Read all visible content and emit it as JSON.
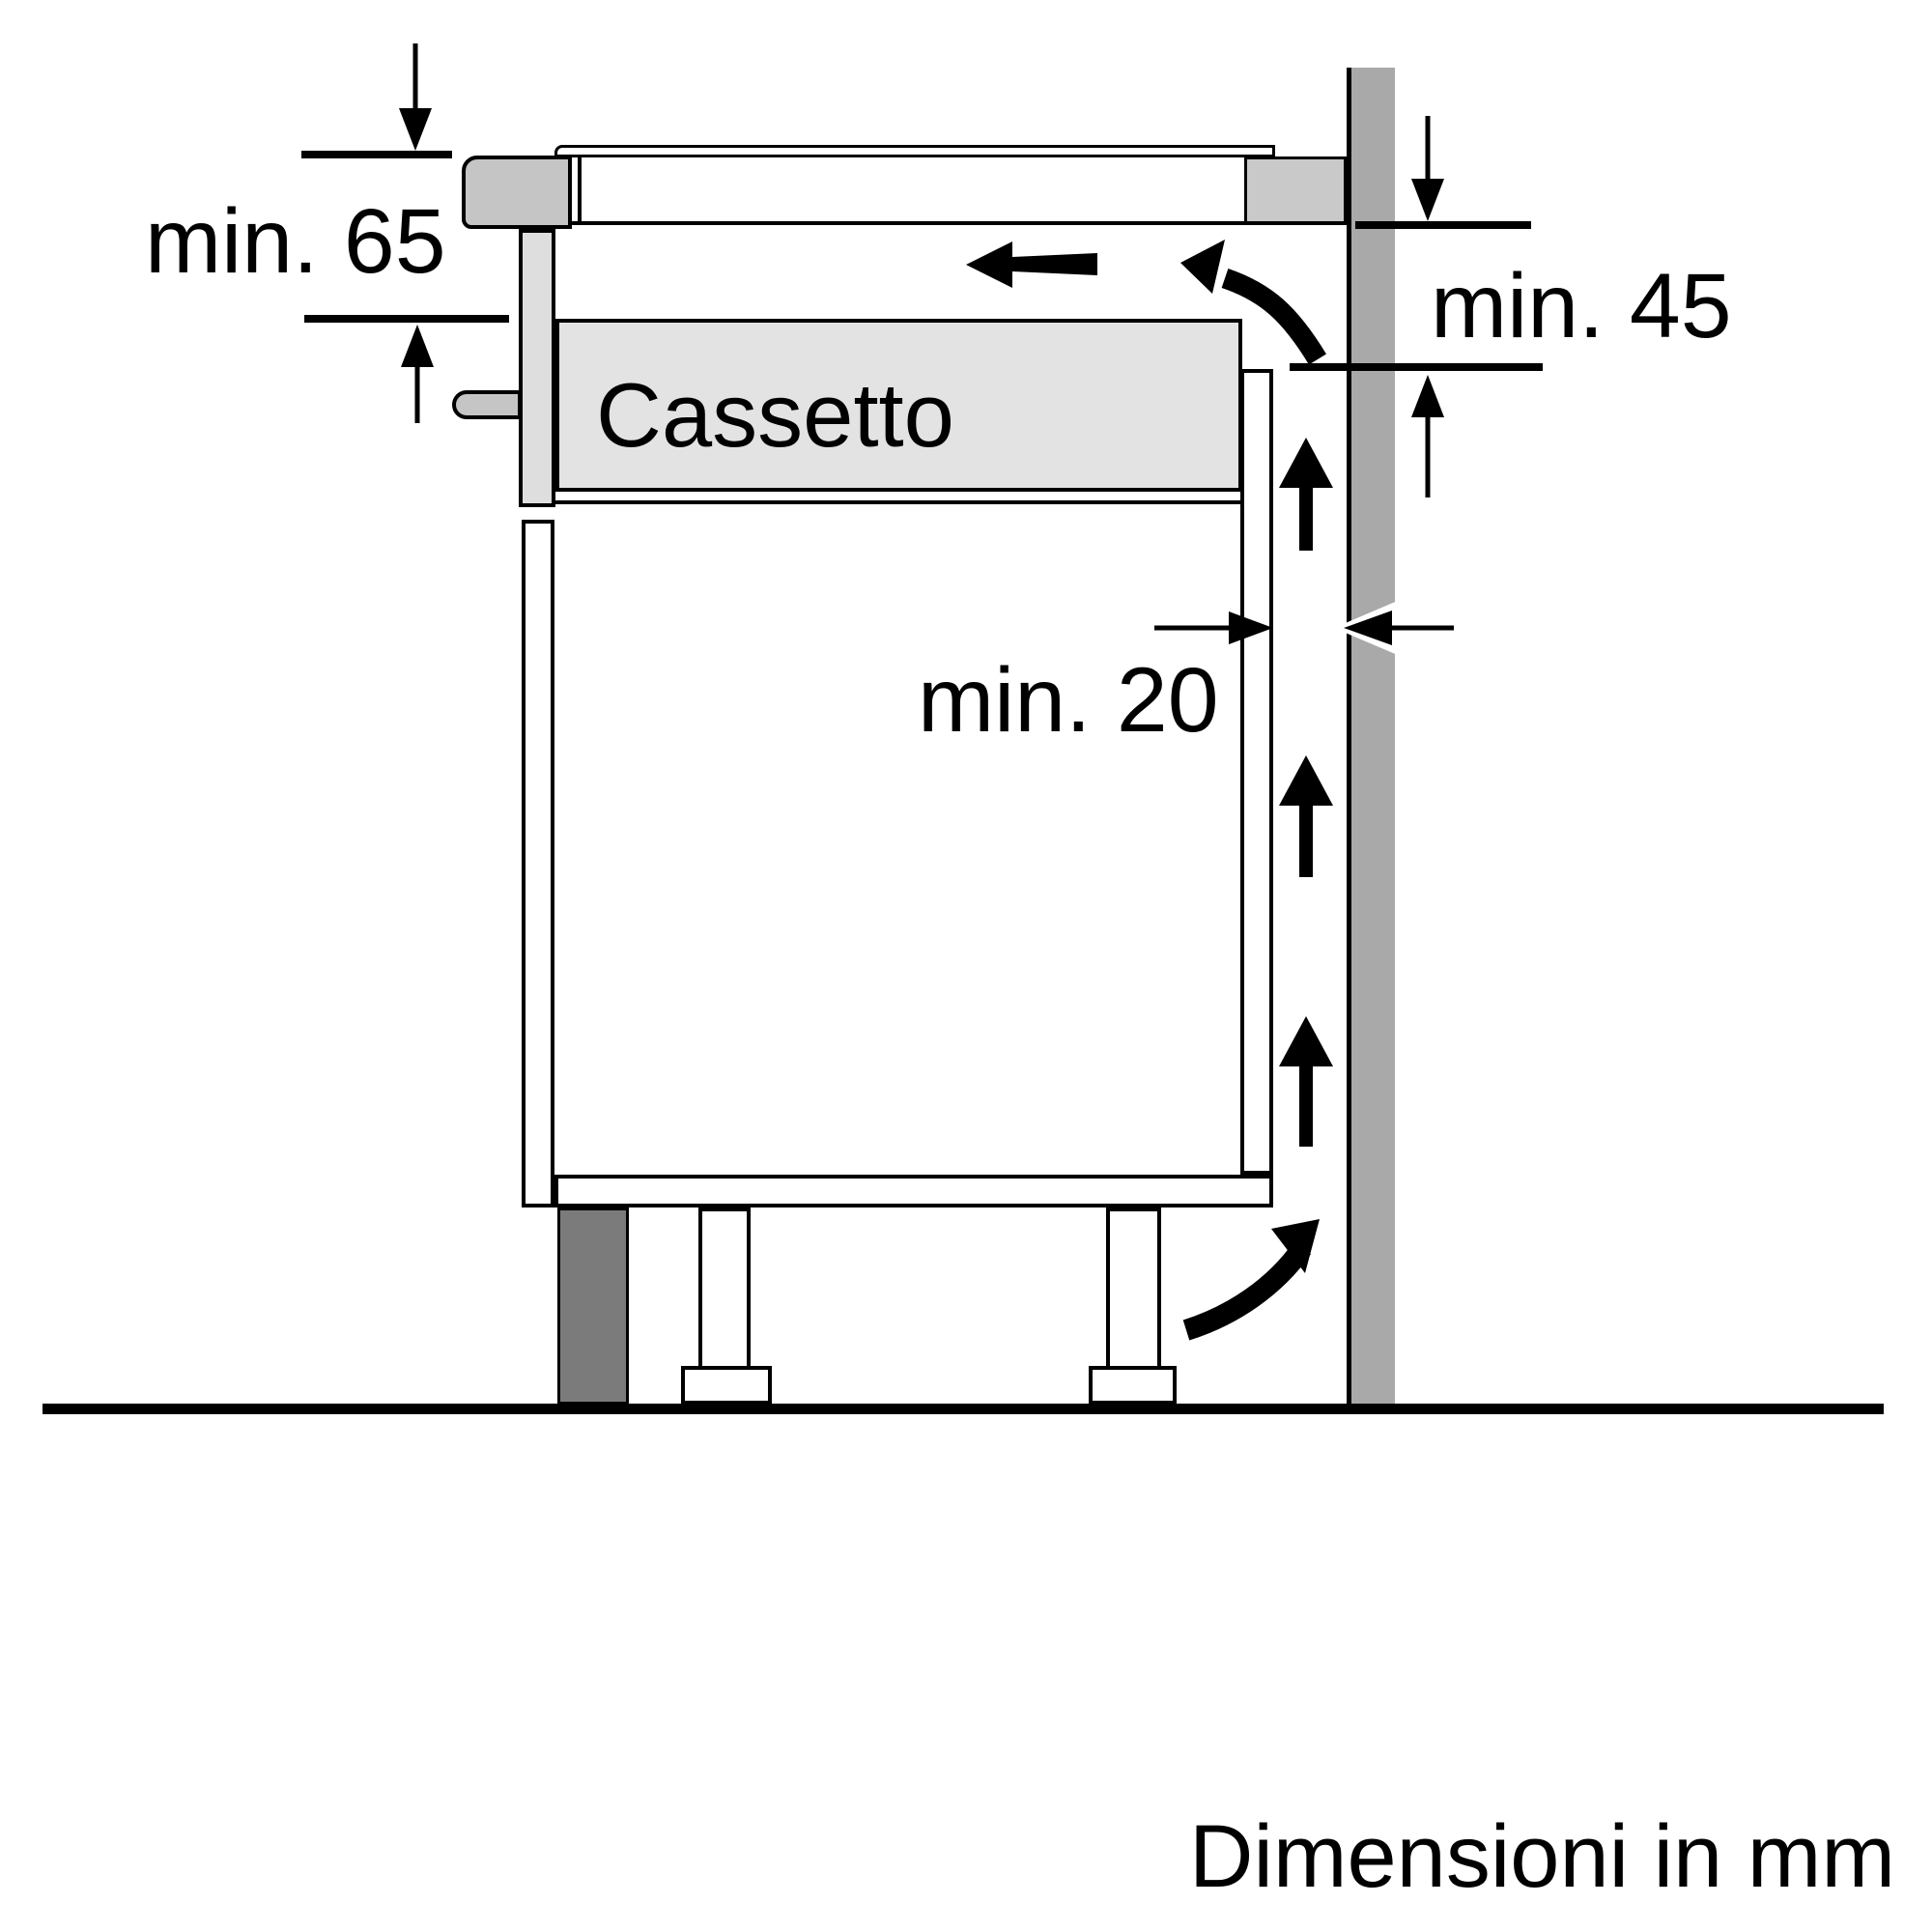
{
  "diagram": {
    "caption": "Dimensioni in mm",
    "drawer_label": "Cassetto",
    "dimensions": {
      "top_clearance": "min. 65",
      "rear_clearance": "min. 45",
      "wall_gap": "min. 20"
    },
    "colors": {
      "background": "#ffffff",
      "outline": "#000000",
      "wall": "#a9a9a9",
      "hob_front_trim": "#c5c5c5",
      "worktop_batten": "#c9c9c9",
      "drawer_fill": "#e3e3e3",
      "front_rail": "#dedede",
      "plinth": "#7b7b7b"
    }
  }
}
